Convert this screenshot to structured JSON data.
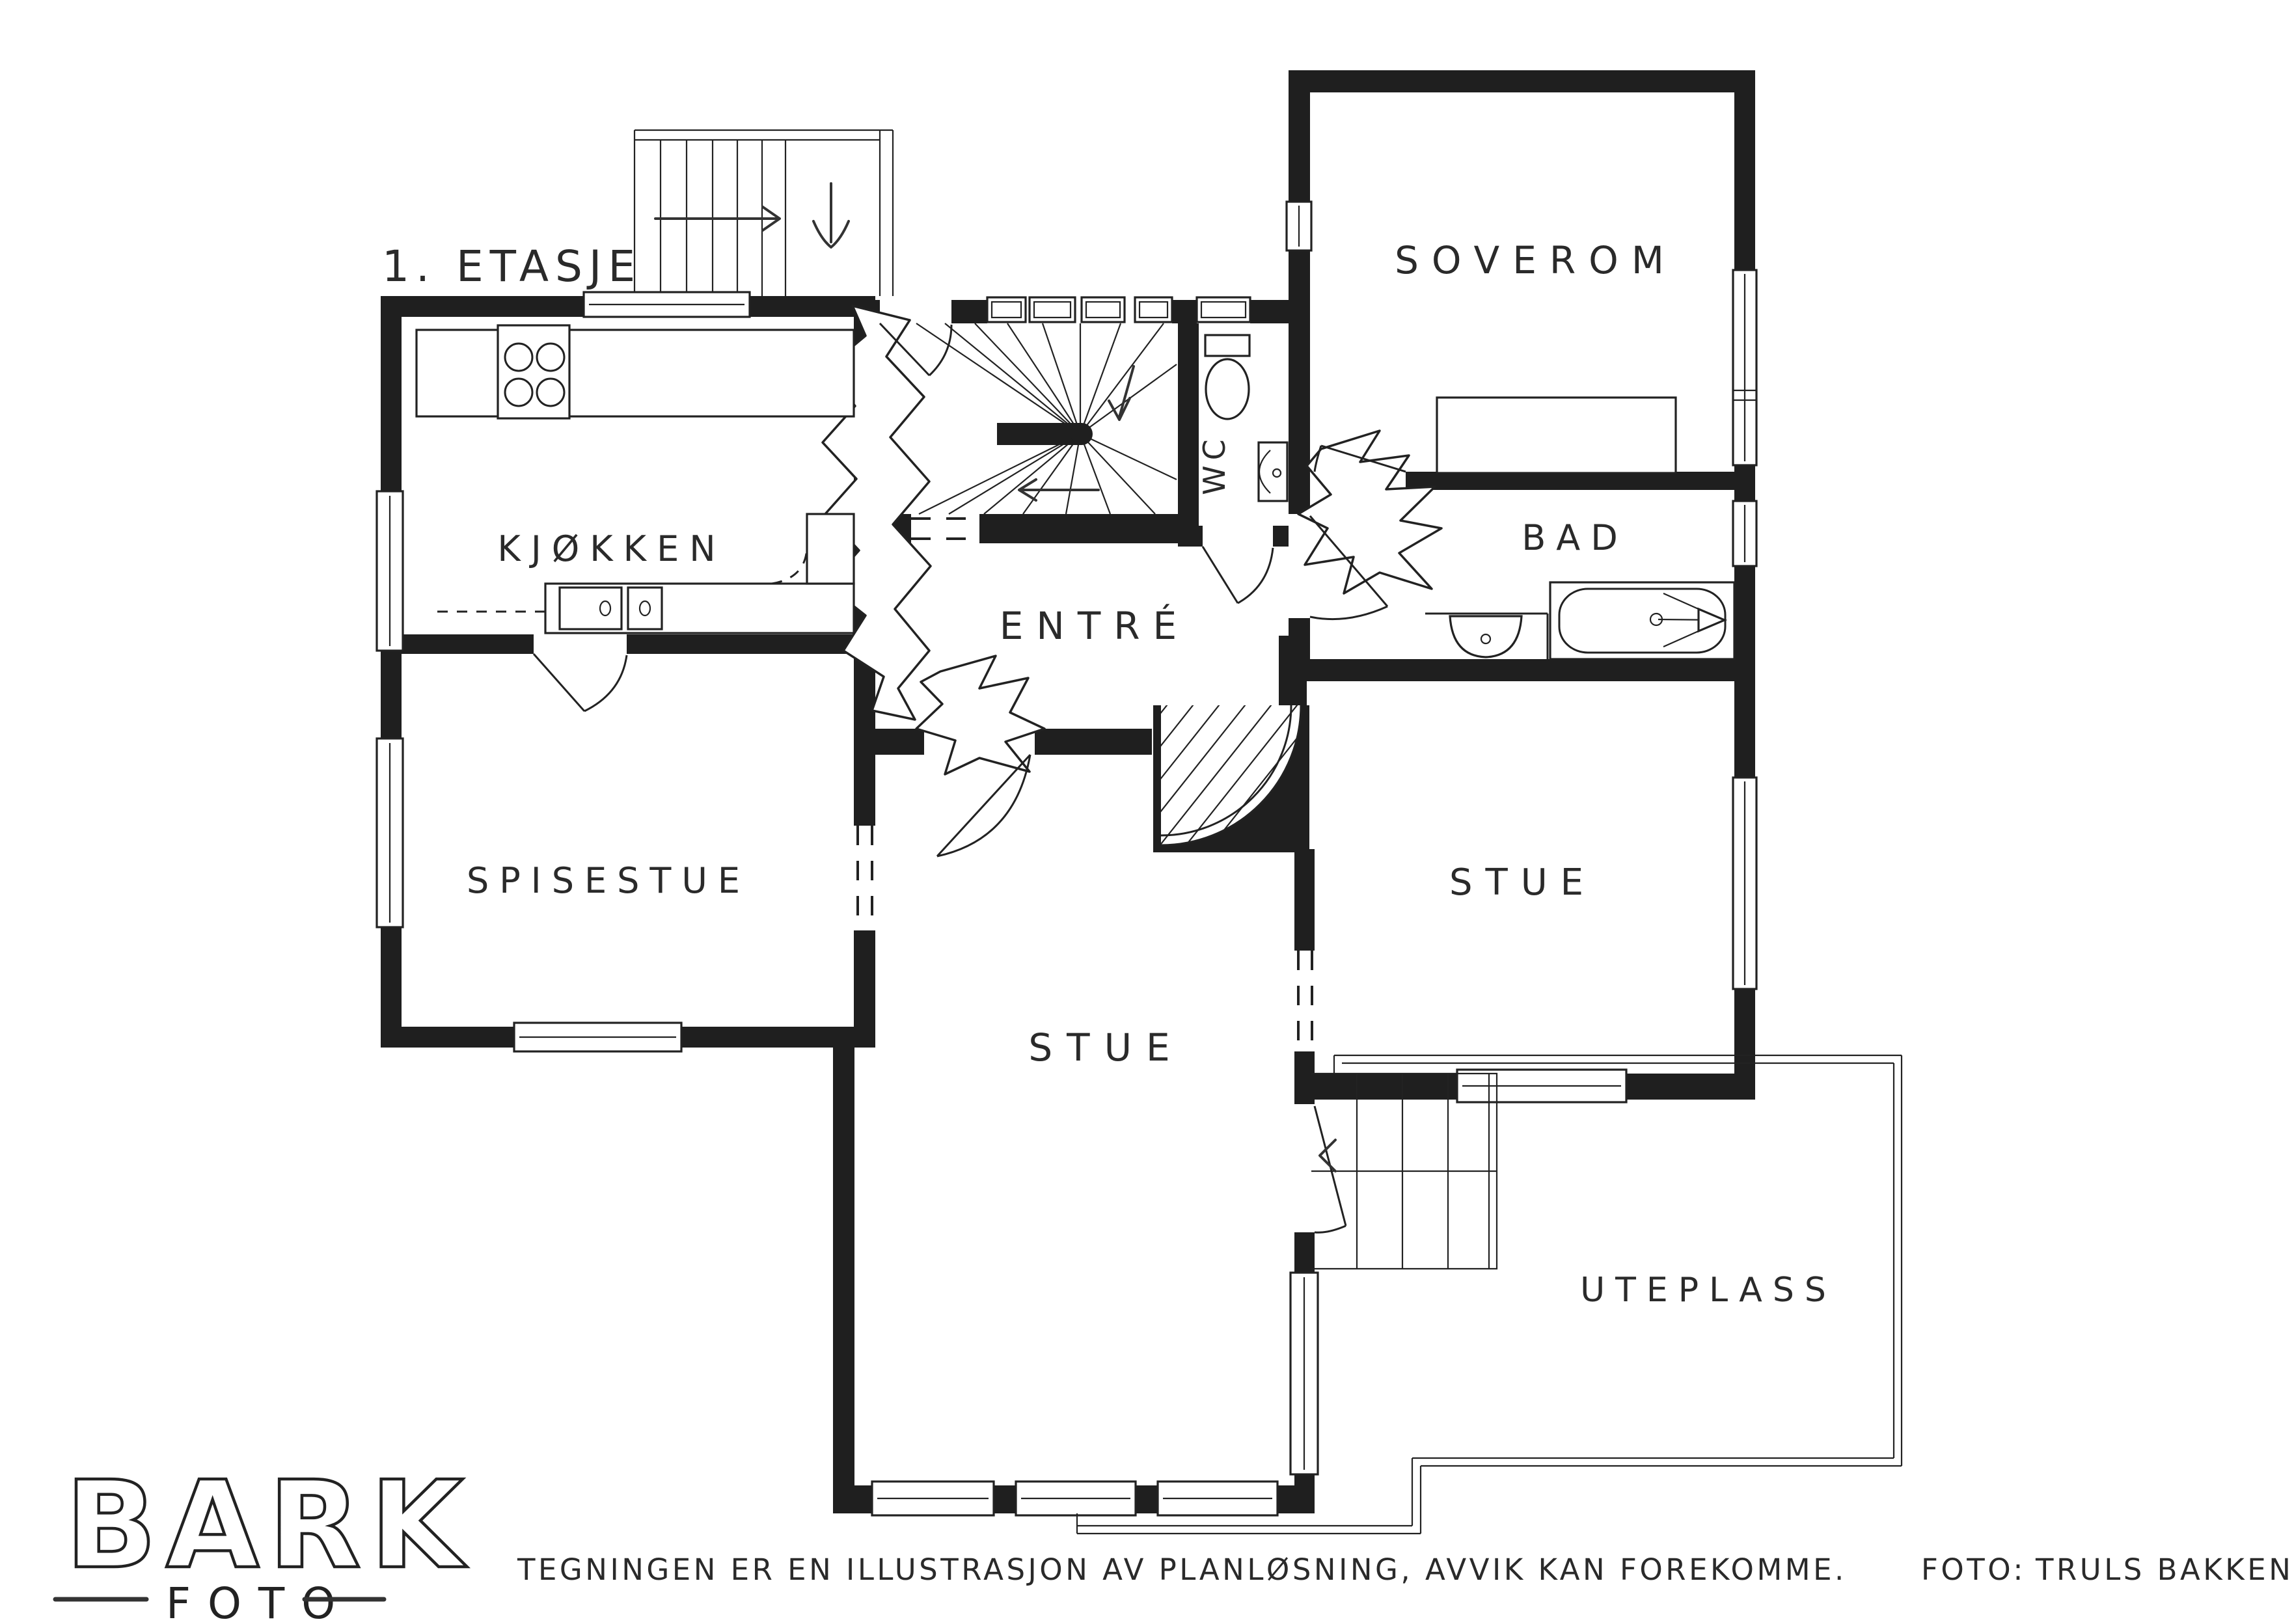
{
  "title": "1. ETASJE",
  "rooms": {
    "kjokken": {
      "label": "KJØKKEN"
    },
    "spisestue": {
      "label": "SPISESTUE"
    },
    "entre": {
      "label": "ENTRÉ"
    },
    "wc": {
      "label": "WC"
    },
    "bad": {
      "label": "BAD"
    },
    "soverom": {
      "label": "SOVEROM"
    },
    "stue_main": {
      "label": "STUE"
    },
    "stue_right": {
      "label": "STUE"
    },
    "uteplass": {
      "label": "UTEPLASS"
    }
  },
  "logo": {
    "name": "BARK",
    "subtitle": "FOTO"
  },
  "footer": {
    "disclaimer": "TEGNINGEN ER EN ILLUSTRASJON AV PLANLØSNING, AVVIK KAN FOREKOMME.",
    "photo_label": "FOTO:",
    "photographer": "TRULS BAKKEN"
  },
  "icons": {
    "stair_up_arrow": "arrow-right",
    "entry_arrow": "arrow-down",
    "stair_down_arrow": "arrow-left"
  },
  "colors": {
    "ink": "#1f1f1f",
    "background": "#ffffff"
  }
}
